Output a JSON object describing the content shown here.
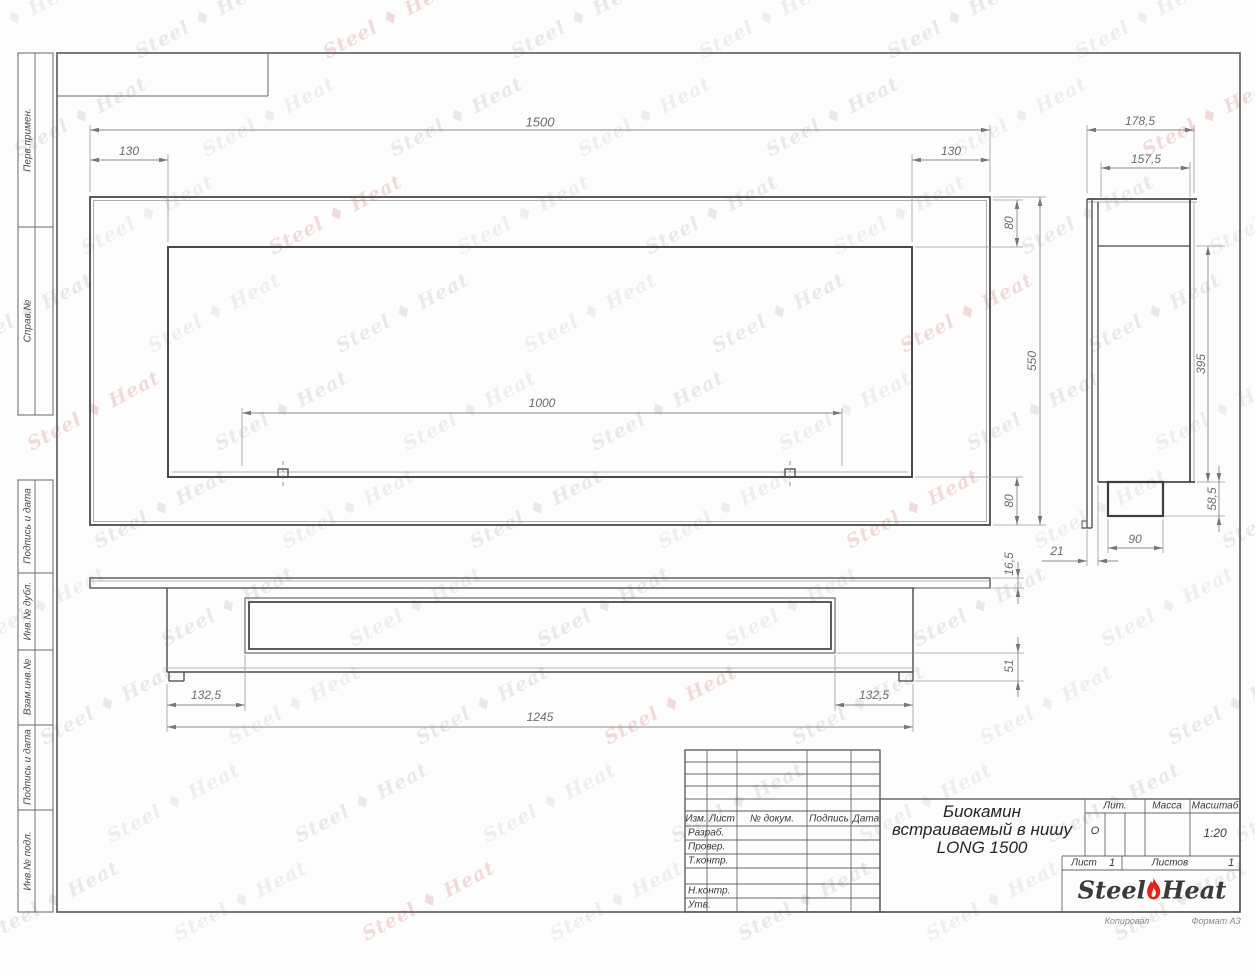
{
  "sidebar": {
    "labels": [
      {
        "id": "perv",
        "label": "Перв.примен."
      },
      {
        "id": "sprav",
        "label": "Справ.№"
      },
      {
        "id": "podp1",
        "label": "Подпись и дата"
      },
      {
        "id": "inv_dubl",
        "label": "Инв.№ дубл."
      },
      {
        "id": "vzam",
        "label": "Взам.инв.№"
      },
      {
        "id": "podp2",
        "label": "Подпись и дата"
      },
      {
        "id": "inv_podl",
        "label": "Инв.№ подл."
      }
    ]
  },
  "dimensions": [
    {
      "id": "front_total_width",
      "label": "1500"
    },
    {
      "id": "front_left_inset",
      "label": "130"
    },
    {
      "id": "front_right_inset",
      "label": "130"
    },
    {
      "id": "front_top_inset",
      "label": "80"
    },
    {
      "id": "front_height",
      "label": "550"
    },
    {
      "id": "front_bottom_inset",
      "label": "80"
    },
    {
      "id": "front_mount_span",
      "label": "1000"
    },
    {
      "id": "side_depth_total",
      "label": "178,5"
    },
    {
      "id": "side_depth_body",
      "label": "157,5"
    },
    {
      "id": "side_height_inner",
      "label": "395"
    },
    {
      "id": "side_burner_height",
      "label": "58,5"
    },
    {
      "id": "side_burner_width",
      "label": "90"
    },
    {
      "id": "side_plate_gap",
      "label": "21"
    },
    {
      "id": "top_flange_thickness",
      "label": "16,5"
    },
    {
      "id": "top_body_depth",
      "label": "51"
    },
    {
      "id": "top_left_inset",
      "label": "132,5"
    },
    {
      "id": "top_body_width",
      "label": "1245"
    },
    {
      "id": "top_right_inset",
      "label": "132,5"
    }
  ],
  "title_block": {
    "header_cols": [
      "Изм.",
      "Лист",
      "№ докум.",
      "Подпись",
      "Дата"
    ],
    "row_labels": [
      "Разраб.",
      "Провер.",
      "Т.контр.",
      "Н.контр.",
      "Утв."
    ],
    "doc_title_line1": "Биокамин",
    "doc_title_line2": "встраиваемый в нишу",
    "doc_title_line3": "LONG 1500",
    "lit_header": "Лит.",
    "mass_header": "Масса",
    "scale_header": "Масштаб",
    "lit_value": "О",
    "scale_value": "1:20",
    "sheet_label": "Лист",
    "sheet_value": "1",
    "sheets_label": "Листов",
    "sheets_value": "1",
    "footer_left": "Копировал",
    "footer_right": "Формат А3"
  },
  "logo": {
    "part1": "Steel",
    "part2": "Heat",
    "flame_color": "#e8221c"
  },
  "watermark": {
    "brand_left": "Steel",
    "brand_right": "Heat"
  }
}
